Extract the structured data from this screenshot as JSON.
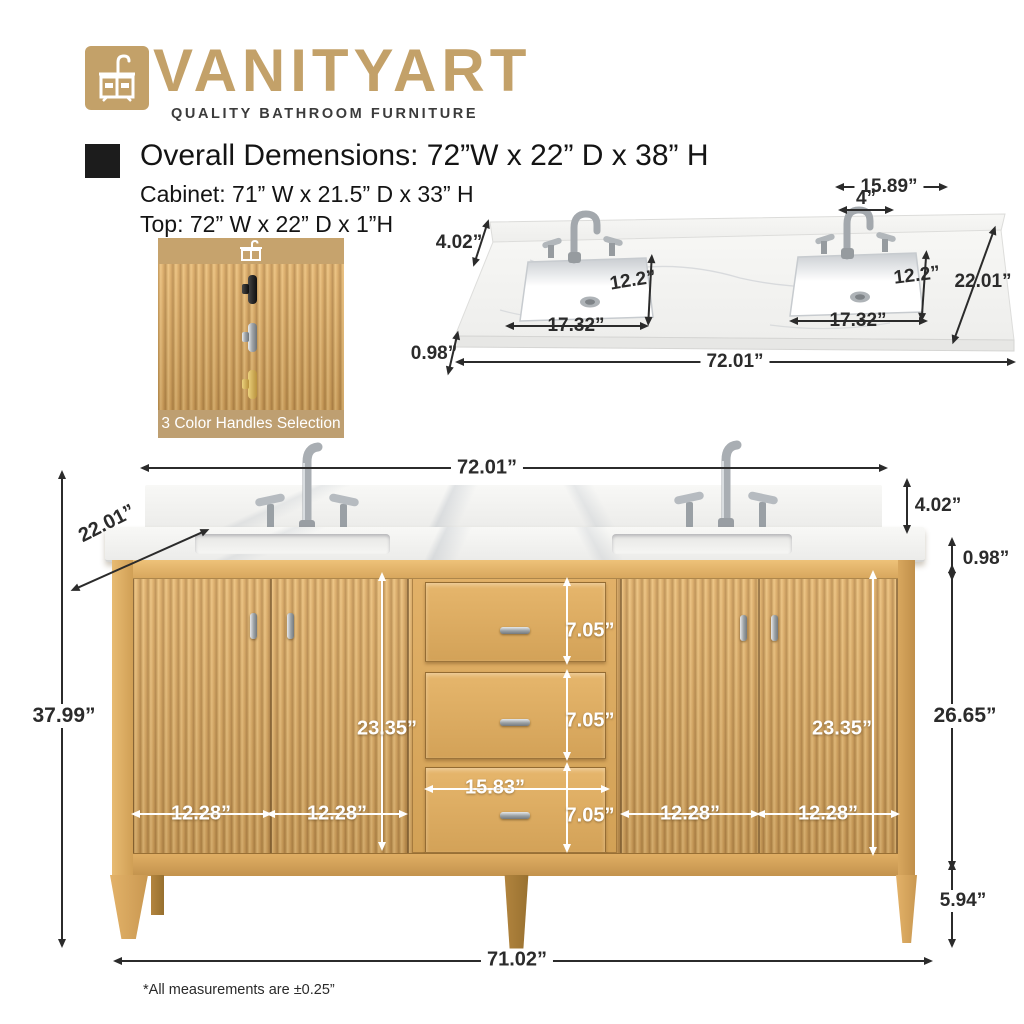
{
  "header": {
    "brand": "VANITYART",
    "tagline": "QUALITY BATHROOM FURNITURE",
    "brand_color": "#C3A169",
    "logo_icon": "vanity-cabinet-icon"
  },
  "specs": {
    "title": "Overall Demensions: 72”W x 22” D x 38” H",
    "cabinet": "Cabinet: 71” W x 21.5” D x 33” H",
    "top": "Top: 72” W x 22” D x 1”H"
  },
  "handles_card": {
    "caption": "3 Color Handles Selection",
    "options": [
      "black",
      "chrome",
      "gold"
    ]
  },
  "top_view": {
    "right_section_width": "15.89”",
    "faucet_spread": "4”",
    "backsplash_height": "4.02”",
    "sink_depth_left": "12.2”",
    "sink_depth_right": "12.2”",
    "total_depth": "22.01”",
    "sink_width_left": "17.32”",
    "sink_width_right": "17.32”",
    "top_thickness": "0.98”",
    "total_width": "72.01”"
  },
  "front_view": {
    "total_width": "72.01”",
    "total_depth": "22.01”",
    "backsplash_height": "4.02”",
    "top_thickness": "0.98”",
    "total_height": "37.99”",
    "cabinet_height": "26.65”",
    "door_height_left": "23.35”",
    "door_height_right": "23.35”",
    "door_widths": [
      "12.28”",
      "12.28”",
      "12.28”",
      "12.28”"
    ],
    "drawer_heights": [
      "7.05”",
      "7.05”",
      "7.05”"
    ],
    "drawer_width": "15.83”",
    "leg_height": "5.94”",
    "base_width": "71.02”"
  },
  "footnote": "*All measurements are ±0.25”",
  "colors": {
    "brand_tan": "#C3A169",
    "wood": "#D8A65E",
    "ink": "#2B2B2B",
    "dim_white": "#FFFFFF"
  }
}
